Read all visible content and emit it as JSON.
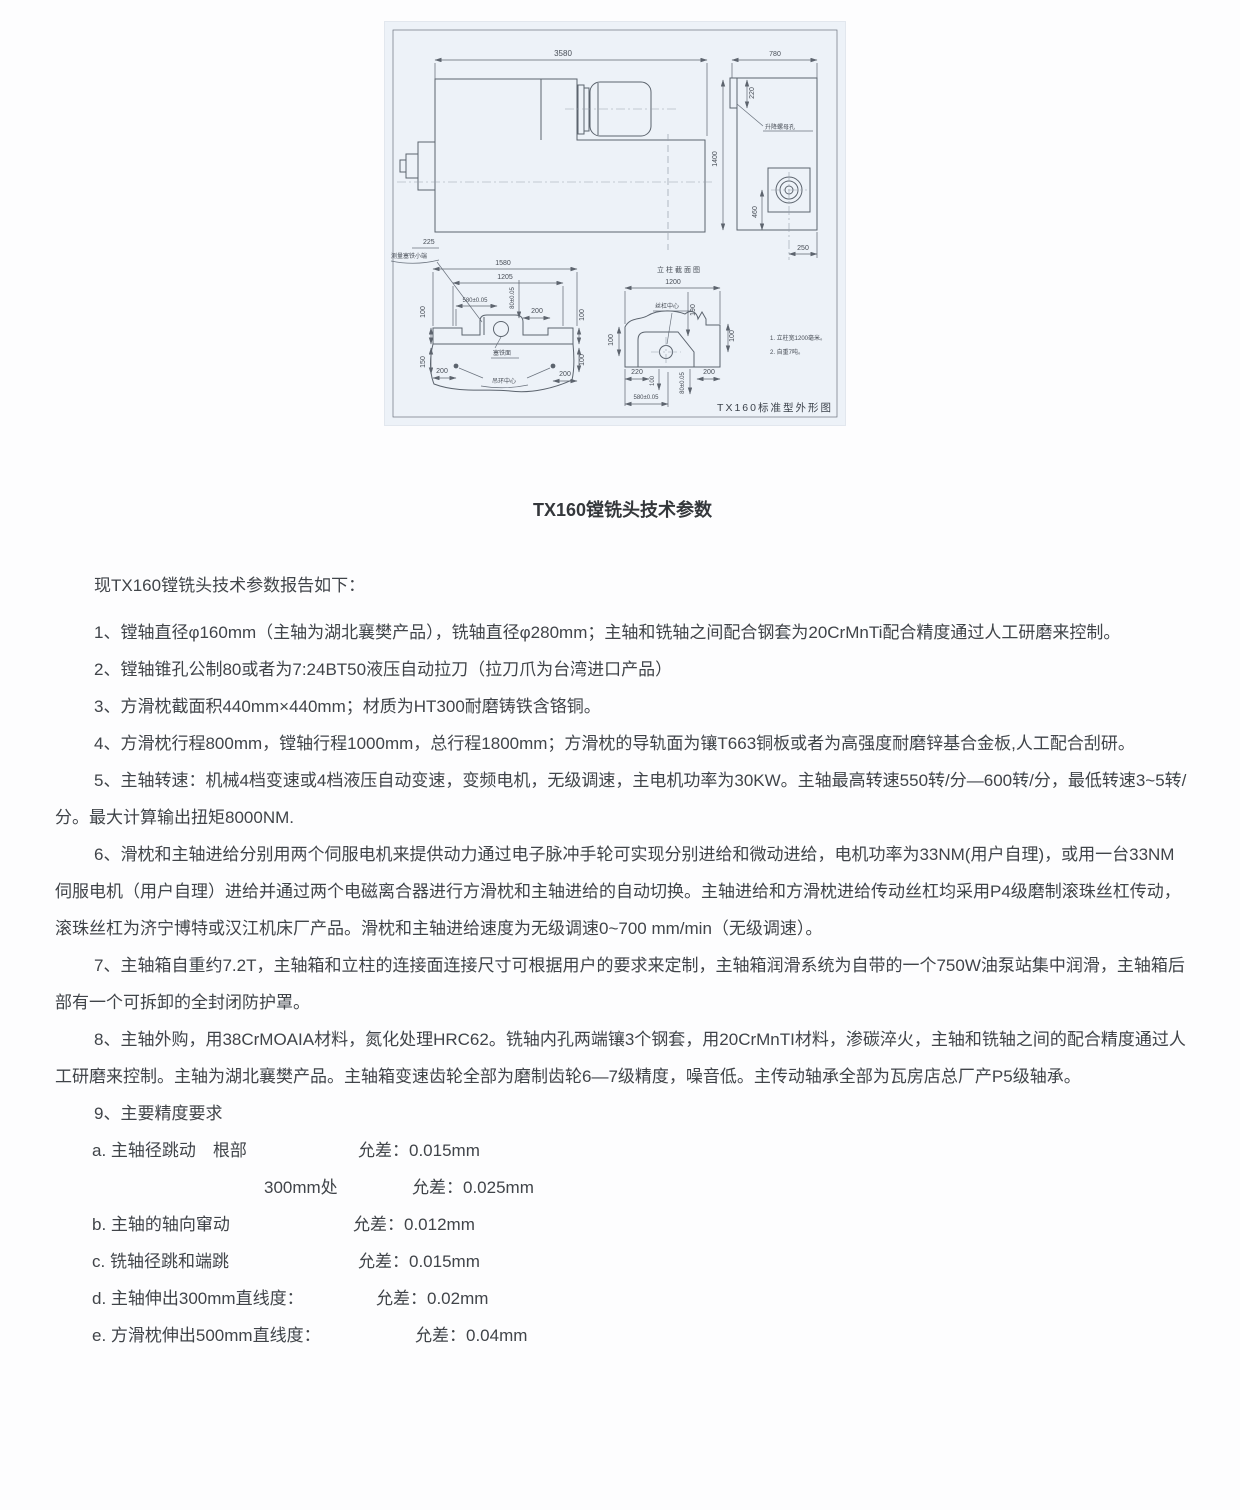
{
  "colors": {
    "page_bg": "#fdfdfe",
    "text": "#404449",
    "drawing_bg": "#edf2f8",
    "drawing_line": "#5c646e"
  },
  "drawing": {
    "caption": "TX160标准型外形图",
    "labels": {
      "d3580": "3580",
      "d780": "780",
      "d220": "220",
      "d1400": "1400",
      "d460": "460",
      "d250": "250",
      "lift_hole": "升降螺母孔",
      "d225": "225",
      "measure_gib": "测量塞铁小端",
      "d1580": "1580",
      "d1205": "1205",
      "d580": "580±0.05",
      "d80": "80±0.05",
      "d200": "200",
      "d100": "100",
      "d150": "150",
      "d190": "190",
      "d1200": "1200",
      "gib_face": "塞铁面",
      "ring_center": "吊环中心",
      "col_section": "立柱截面图",
      "screw_center": "丝杠中心",
      "note1": "1. 立柱宽1200毫米。",
      "note2": "2. 自重7吨。"
    }
  },
  "document": {
    "title": "TX160镗铣头技术参数",
    "intro": "现TX160镗铣头技术参数报告如下：",
    "paragraphs": [
      "1、镗轴直径φ160mm（主轴为湖北襄樊产品），铣轴直径φ280mm；主轴和铣轴之间配合钢套为20CrMnTi配合精度通过人工研磨来控制。",
      "2、镗轴锥孔公制80或者为7:24BT50液压自动拉刀（拉刀爪为台湾进口产品）",
      "3、方滑枕截面积440mm×440mm；材质为HT300耐磨铸铁含铬铜。",
      "4、方滑枕行程800mm，镗轴行程1000mm，总行程1800mm；方滑枕的导轨面为镶T663铜板或者为高强度耐磨锌基合金板,人工配合刮研。",
      "5、主轴转速：机械4档变速或4档液压自动变速，变频电机，无级调速，主电机功率为30KW。主轴最高转速550转/分—600转/分，最低转速3~5转/分。最大计算输出扭矩8000NM.",
      "6、滑枕和主轴进给分别用两个伺服电机来提供动力通过电子脉冲手轮可实现分别进给和微动进给，电机功率为33NM(用户自理)，或用一台33NM伺服电机（用户自理）进给并通过两个电磁离合器进行方滑枕和主轴进给的自动切换。主轴进给和方滑枕进给传动丝杠均采用P4级磨制滚珠丝杠传动，滚珠丝杠为济宁博特或汉江机床厂产品。滑枕和主轴进给速度为无级调速0~700 mm/min（无级调速）。",
      "7、主轴箱自重约7.2T，主轴箱和立柱的连接面连接尺寸可根据用户的要求来定制，主轴箱润滑系统为自带的一个750W油泵站集中润滑，主轴箱后部有一个可拆卸的全封闭防护罩。",
      "8、主轴外购，用38CrMOAIA材料，氮化处理HRC62。铣轴内孔两端镶3个钢套，用20CrMnTI材料，渗碳淬火，主轴和铣轴之间的配合精度通过人工研磨来控制。主轴为湖北襄樊产品。主轴箱变速齿轮全部为磨制齿轮6—7级精度，噪音低。主传动轴承全部为瓦房店总厂产P5级轴承。",
      "9、主要精度要求"
    ],
    "precision": [
      {
        "label": "a. 主轴径跳动　根部",
        "value": "允差：0.015mm"
      },
      {
        "label": "300mm处",
        "value": "允差：0.025mm"
      },
      {
        "label": "b. 主轴的轴向窜动",
        "value": "允差：0.012mm"
      },
      {
        "label": "c. 铣轴径跳和端跳",
        "value": "允差：0.015mm"
      },
      {
        "label": "d. 主轴伸出300mm直线度：",
        "value": "允差：0.02mm"
      },
      {
        "label": "e. 方滑枕伸出500mm直线度：",
        "value": "允差：0.04mm"
      }
    ]
  }
}
